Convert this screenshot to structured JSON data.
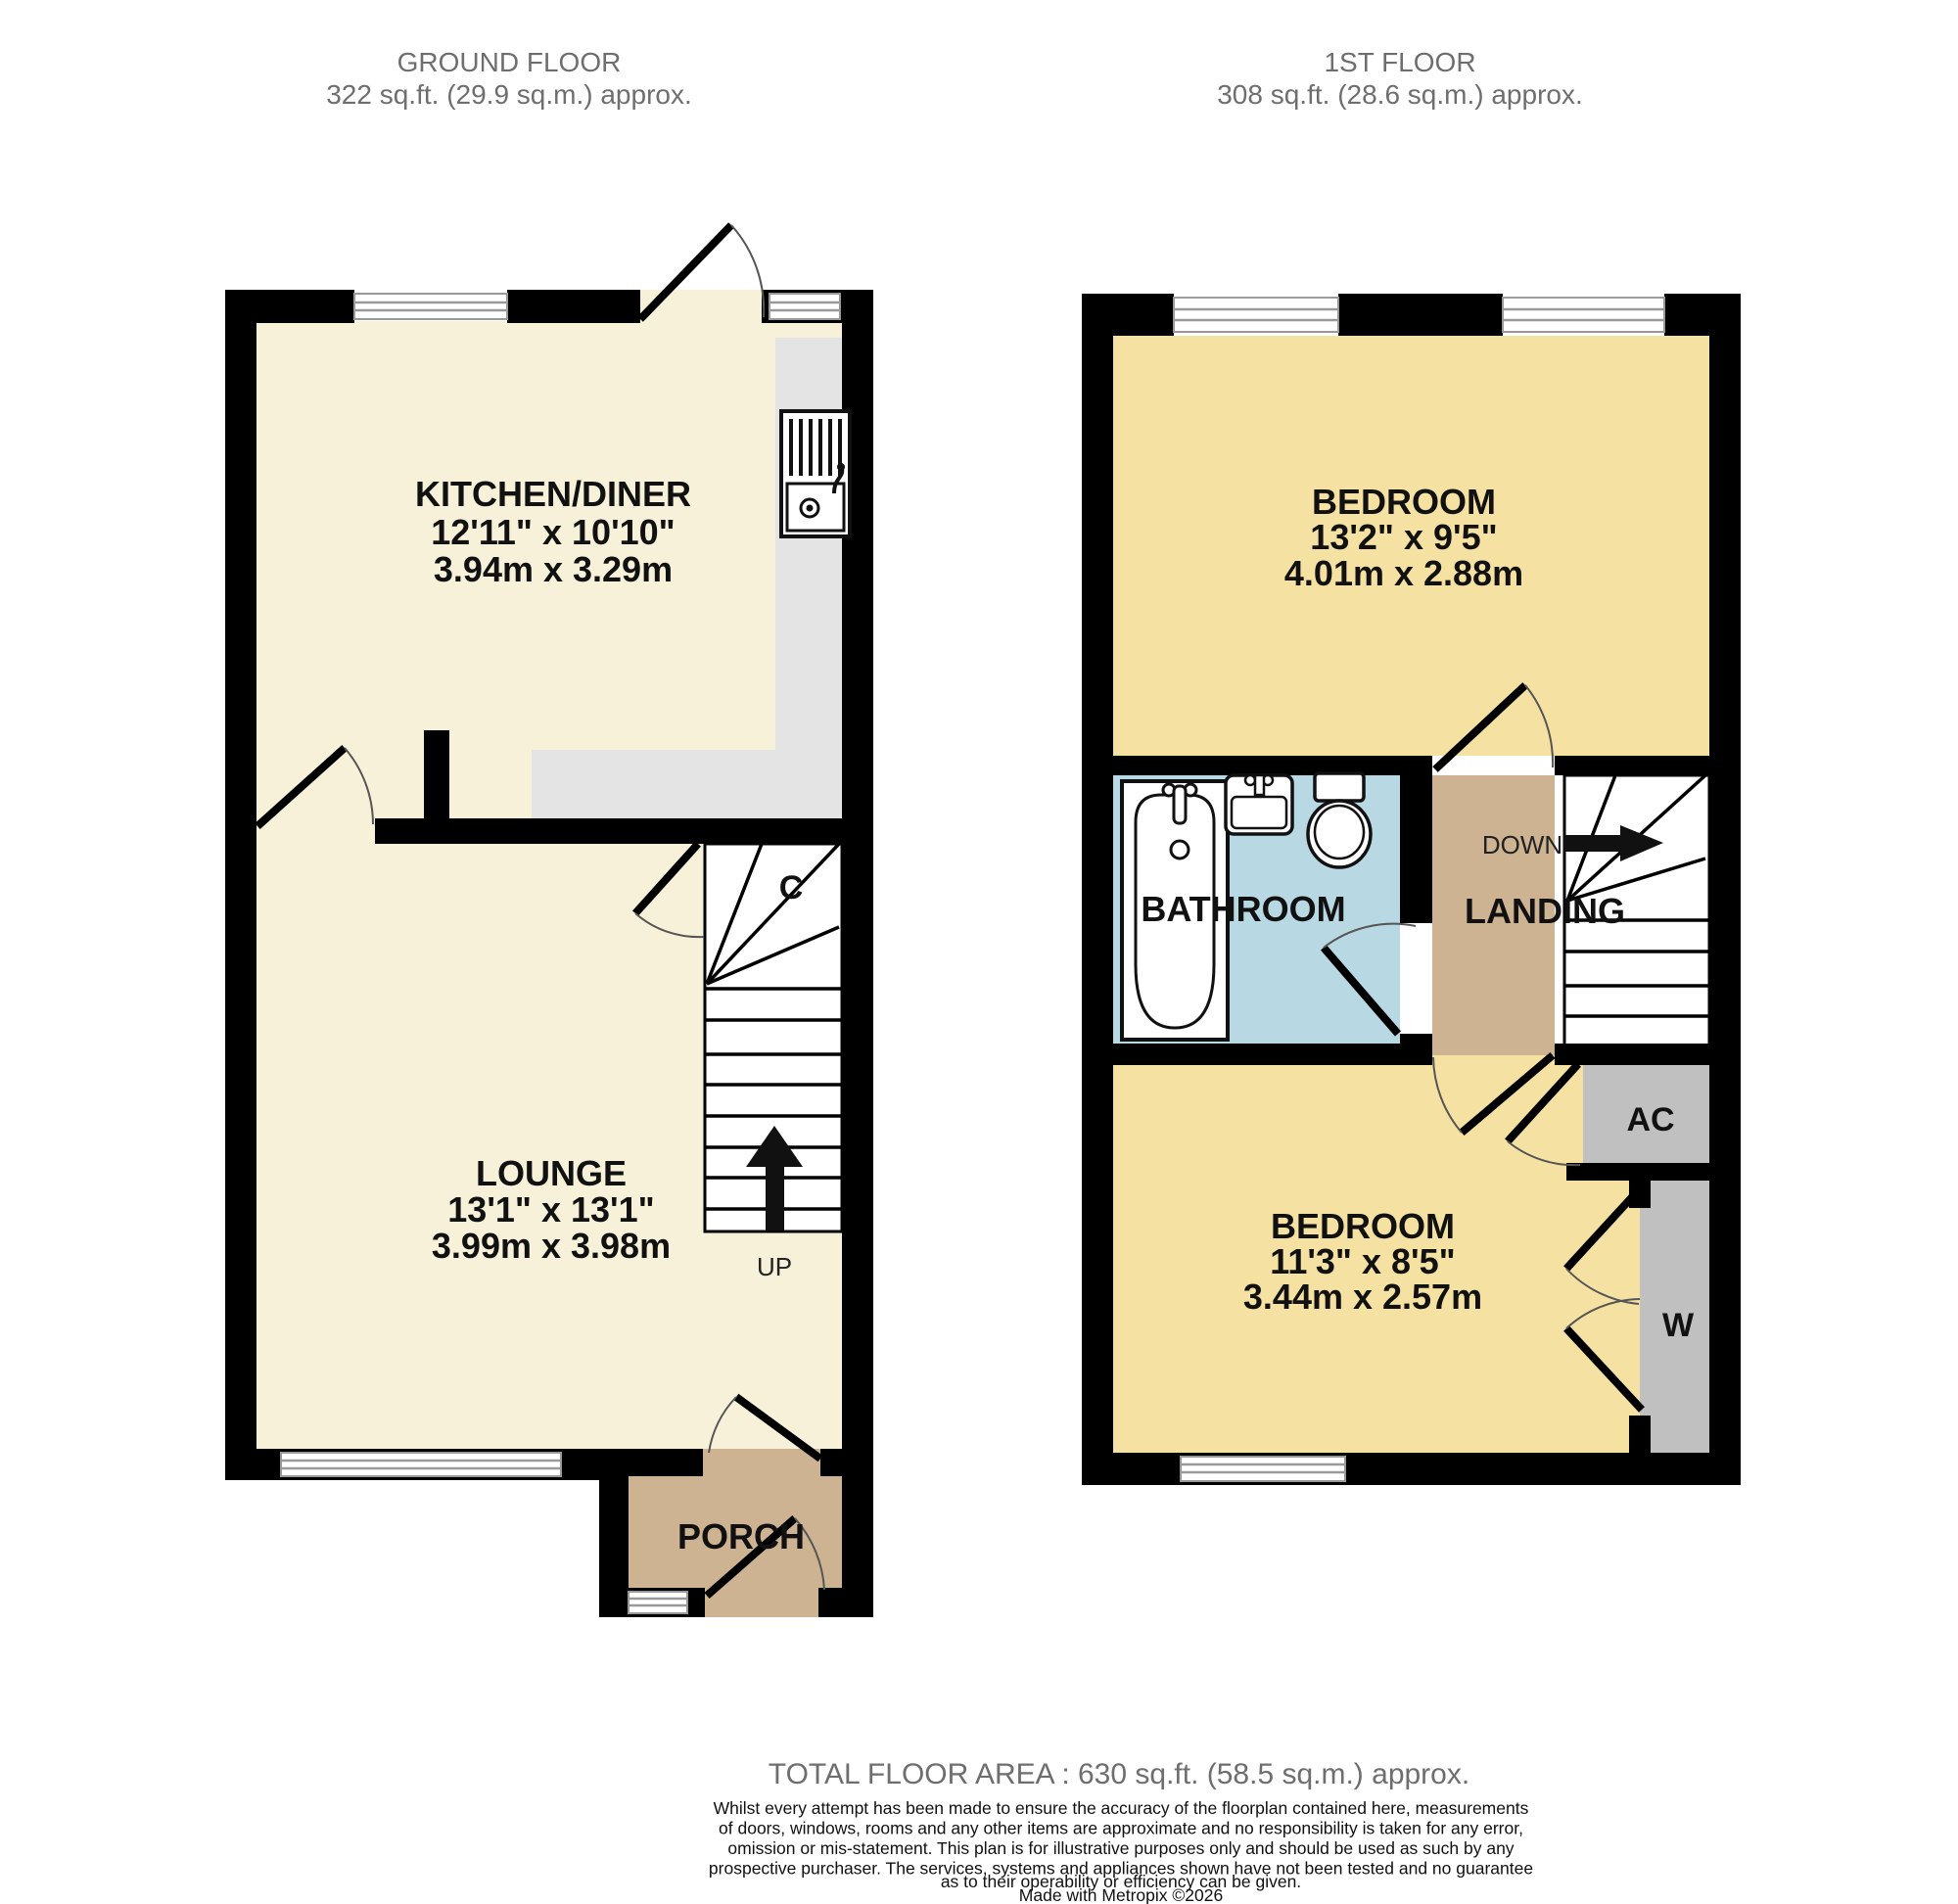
{
  "header": {
    "ground_floor": {
      "title": "GROUND FLOOR",
      "area": "322 sq.ft. (29.9 sq.m.) approx."
    },
    "first_floor": {
      "title": "1ST FLOOR",
      "area": "308 sq.ft. (28.6 sq.m.) approx."
    }
  },
  "ground_floor": {
    "kitchen_diner": {
      "name": "KITCHEN/DINER",
      "dims_imperial": "12'11\"  x 10'10\"",
      "dims_metric": "3.94m  x 3.29m"
    },
    "lounge": {
      "name": "LOUNGE",
      "dims_imperial": "13'1\"  x 13'1\"",
      "dims_metric": "3.99m  x 3.98m"
    },
    "porch": {
      "name": "PORCH"
    },
    "cupboard_label": "C",
    "stairs_label": "UP"
  },
  "first_floor": {
    "bedroom1": {
      "name": "BEDROOM",
      "dims_imperial": "13'2\"  x 9'5\"",
      "dims_metric": "4.01m  x 2.88m"
    },
    "bedroom2": {
      "name": "BEDROOM",
      "dims_imperial": "11'3\"  x 8'5\"",
      "dims_metric": "3.44m  x 2.57m"
    },
    "bathroom": {
      "name": "BATHROOM"
    },
    "landing": {
      "name": "LANDING",
      "stairs_label": "DOWN"
    },
    "airing_cupboard_label": "AC",
    "wardrobe_label": "W"
  },
  "footer": {
    "total_area": "TOTAL FLOOR AREA : 630 sq.ft. (58.5 sq.m.) approx.",
    "disclaimer_lines": [
      "Whilst every attempt has been made to ensure the accuracy of the floorplan contained here, measurements",
      "of doors, windows, rooms and any other items are approximate and no responsibility is taken for any error,",
      "omission or mis-statement. This plan is for illustrative purposes only and should be used as such by any",
      "prospective purchaser. The services, systems and appliances shown have not been tested and no guarantee",
      "as to their operability or efficiency can be given."
    ],
    "credit": "Made with Metropix ©2026"
  },
  "colors": {
    "wall": "#000000",
    "room_cream": "#f7f1d9",
    "room_yellow": "#f5e2a2",
    "zone_tan": "#cdb392",
    "zone_blue": "#b8d9e3",
    "counter_gray": "#e4e4e4",
    "storage_gray": "#c0c0c0",
    "muted_text": "#6e6e6e"
  }
}
